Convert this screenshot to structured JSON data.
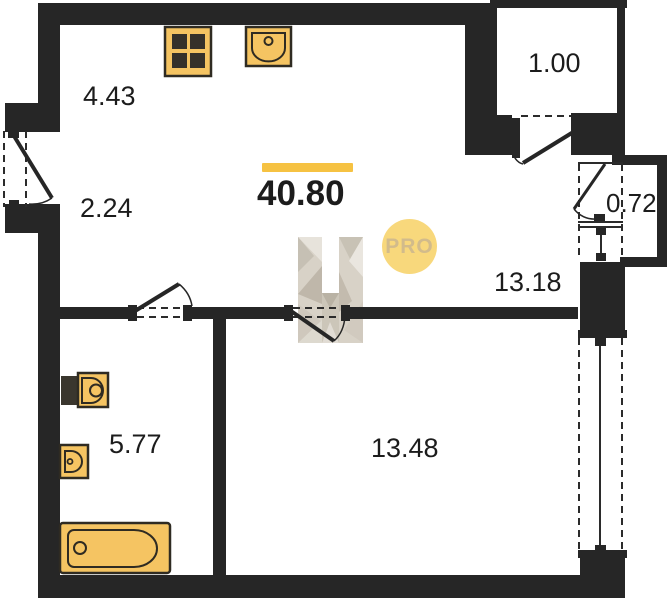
{
  "title": "apartment-floor-plan",
  "total_area": "40.80",
  "badge": "PRO",
  "rooms": {
    "corridor": "4.43",
    "hall": "2.24",
    "kitchen_living": "13.18",
    "balcony": "1.00",
    "duct": "0.72",
    "bathroom": "5.77",
    "bedroom": "13.48"
  },
  "icons": {
    "stove": "stove-icon",
    "kitchen_sink": "kitchen-sink-icon",
    "toilet": "toilet-icon",
    "washbasin": "washbasin-icon",
    "bathtub": "bathtub-icon",
    "watermark": "builder-logo-watermark"
  },
  "colors": {
    "wall": "#262626",
    "fixture": "#f5c462",
    "accent": "#f6c242",
    "badge_bg": "#f8d87c",
    "badge_text": "#d2bb8b"
  }
}
